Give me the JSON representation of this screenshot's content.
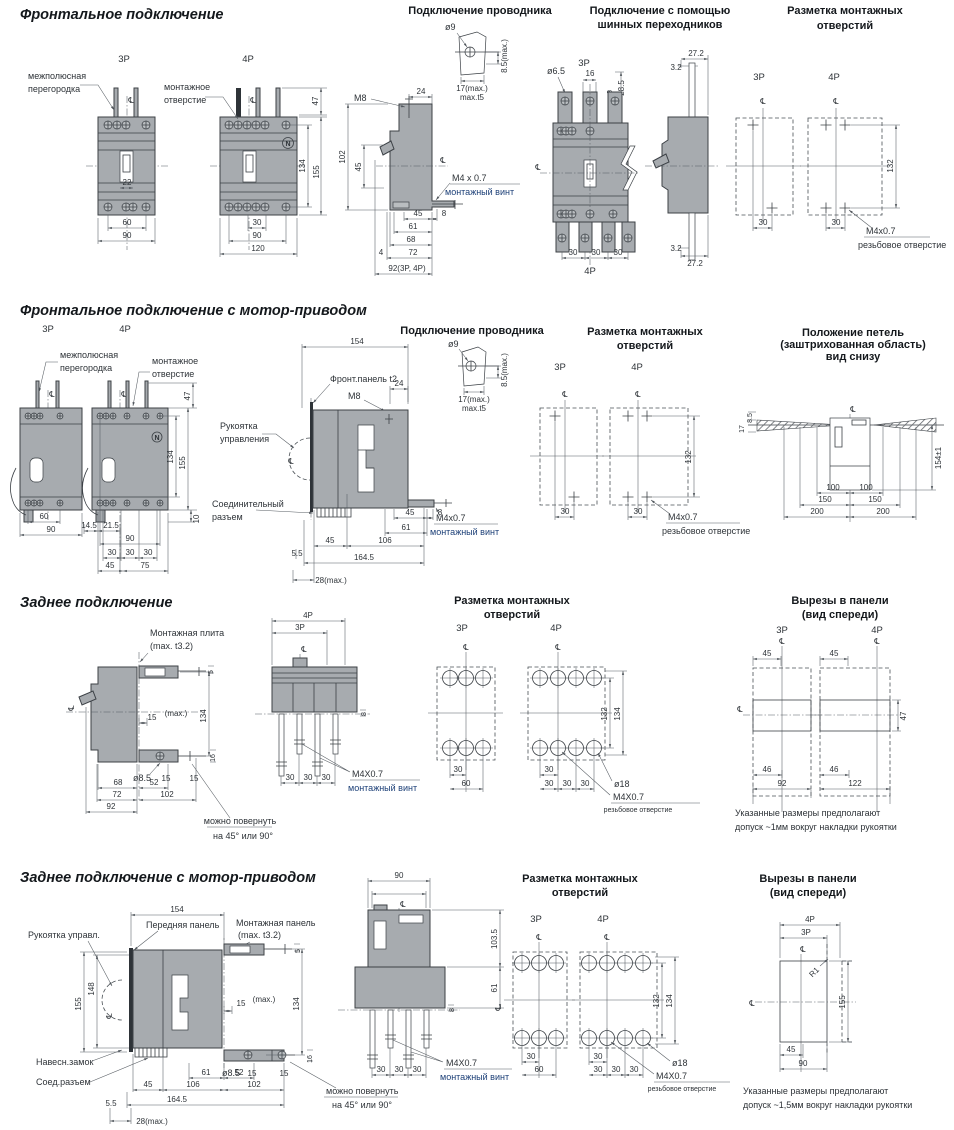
{
  "page": {
    "background": "#ffffff"
  },
  "colors": {
    "body_fill": "#a7abaf",
    "line": "#3c4146",
    "navy_label": "#1d4078"
  },
  "sym": {
    "cl": "℄",
    "p3": "3P",
    "p4": "4P",
    "n_mark": "N",
    "wire_title": "Подключение проводника",
    "holes_title1": "Разметка монтажных",
    "holes_title2": "отверстий",
    "cut_title1": "Вырезы в панели",
    "cut_title2": "(вид спереди)",
    "rotate1": "можно повернуть",
    "rotate2": "на 45° или 90°",
    "barrier1": "межполюсная",
    "barrier2": "перегородка",
    "mhole1": "монтажное",
    "mhole2": "отверстие",
    "mount_screw": "монтажный винт",
    "thread_hole": "резьбовое отверстие",
    "max": "(max.)",
    "d4": "4",
    "d5": "5",
    "d8": "8",
    "d10": "10",
    "d15": "15",
    "d16": "16",
    "d17max": "17(max.)",
    "t5": "max.t5",
    "d85max": "8.5(max.)",
    "d9": "ø9",
    "d22": "22",
    "d24": "24",
    "d28max": "28(max.)",
    "d30": "30",
    "d45": "45",
    "d46": "46",
    "d47": "47",
    "d52": "52",
    "d55": "5.5",
    "d60": "60",
    "d61": "61",
    "d68": "68",
    "d72": "72",
    "d75": "75",
    "d86": "86",
    "d90": "90",
    "d92": "92",
    "d102": "102",
    "d106": "106",
    "d120": "120",
    "d122": "122",
    "d132": "132",
    "d134": "134",
    "d148": "148",
    "d154": "154",
    "d155": "155",
    "d164": "164.5",
    "d18": "ø18",
    "d85": "ø8.5",
    "m8": "M8"
  },
  "s1": {
    "title": "Фронтальное подключение",
    "wire": {
      "m4": "M4 x 0.7",
      "d92": "92(3P, 4P)"
    },
    "bus": {
      "t1": "Подключение с помощью",
      "t2": "шинных переходников",
      "d65": "ø6.5",
      "d285": "28.5",
      "d272": "27.2",
      "d32": "3.2",
      "d16": "16"
    },
    "holes": {
      "m4": "M4x0.7"
    }
  },
  "s2": {
    "title": "Фронтальное подключение с мотор-приводом",
    "front": {
      "d145": "14.5",
      "d215": "21.5"
    },
    "side": {
      "fpanel": "Фронт.панель t2",
      "handle1": "Рукоятка",
      "handle2": "управления",
      "conn1": "Соединительный",
      "conn2": "разъем",
      "m4": "M4x0.7"
    },
    "holes": {
      "m4": "M4x0.7"
    },
    "loops": {
      "t1": "Положение петель",
      "t2": "(заштрихованная область)",
      "t3": "вид снизу",
      "d154t": "154±1",
      "d100": "100",
      "d150": "150",
      "d200": "200",
      "d17": "17",
      "d85": "8.5"
    }
  },
  "s3": {
    "title": "Заднее подключение",
    "side": {
      "plate1": "Монтажная плита",
      "plate2": "(max. t3.2)"
    },
    "rear": {
      "m4": "M4X0.7"
    },
    "holes": {
      "m4": "M4X0.7"
    },
    "cut": {
      "note1": "Указанные размеры предполагают",
      "note2": "допуск ~1мм вокруг накладки рукоятки"
    }
  },
  "s4": {
    "title": "Заднее подключение с мотор-приводом",
    "side": {
      "handle": "Рукоятка управл.",
      "fpanel": "Передняя панель",
      "mpanel1": "Монтажная панель",
      "mpanel2": "(max. t3.2)",
      "lock": "Навесн.замок",
      "conn": "Соед.разъем"
    },
    "rear": {
      "d1035": "103.5",
      "m4": "M4X0.7"
    },
    "holes": {
      "m4": "M4X0.7"
    },
    "cut": {
      "r1": "R1",
      "note1": "Указанные размеры предполагают",
      "note2": "допуск ~1,5мм вокруг накладки рукоятки"
    }
  }
}
